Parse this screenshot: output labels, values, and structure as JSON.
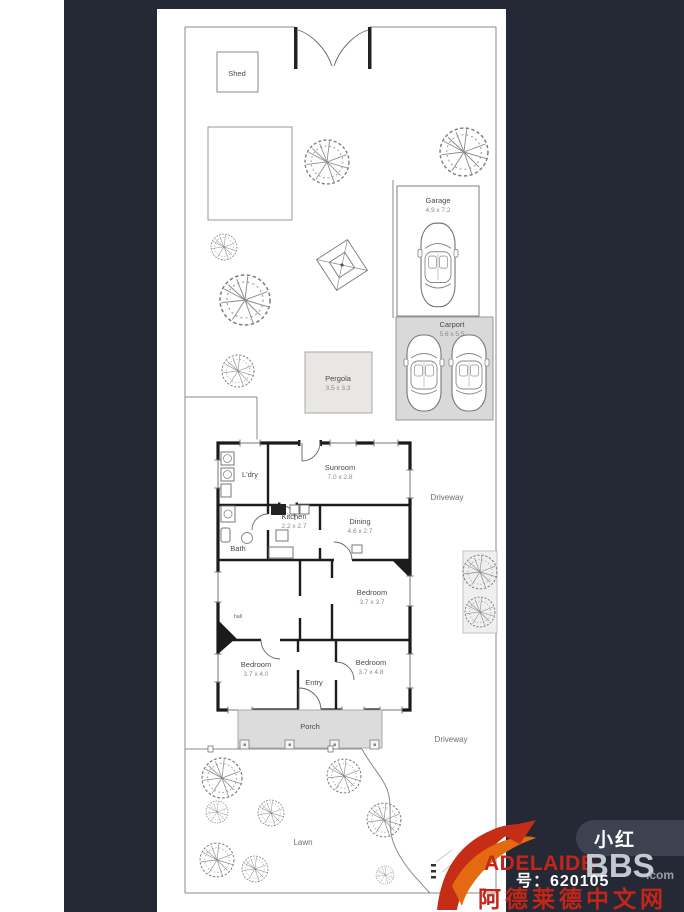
{
  "colors": {
    "page_bg": "#ffffff",
    "image_bg": "#242935",
    "sheet_bg": "#ffffff",
    "carport_fill": "#d9d9d9",
    "pergola_fill": "#e8e7e4",
    "porch_fill": "#dcdcdc",
    "paving_fill": "#efefef",
    "badge_bg": "#3c4250",
    "brand_red": "#c32619",
    "brand_gray": "#c3c9d2",
    "brand_tld_gray": "#99a0aa",
    "acct_white": "#ffffff"
  },
  "plan": {
    "shed": {
      "label": "Shed"
    },
    "garage": {
      "label": "Garage",
      "dims": "4.9 x 7.2"
    },
    "carport": {
      "label": "Carport",
      "dims": "5.6 x 5.5"
    },
    "pergola": {
      "label": "Pergola",
      "dims": "3.5 x 3.3"
    },
    "laundry": {
      "label": "L'dry"
    },
    "sunroom": {
      "label": "Sunroom",
      "dims": "7.0 x 2.8"
    },
    "kitchen": {
      "label": "Kitchen",
      "dims": "2.2 x 2.7"
    },
    "dining": {
      "label": "Dining",
      "dims": "4.6 x 2.7"
    },
    "bath": {
      "label": "Bath"
    },
    "hall": {
      "label": "hall"
    },
    "bedroom_mid": {
      "label": "Bedroom",
      "dims": "3.7 x 3.7"
    },
    "bedroom_front_left": {
      "label": "Bedroom",
      "dims": "3.7 x 4.0"
    },
    "entry": {
      "label": "Entry"
    },
    "bedroom_front_right": {
      "label": "Bedroom",
      "dims": "3.7 x 4.8"
    },
    "porch": {
      "label": "Porch"
    },
    "lawn": {
      "label": "Lawn"
    },
    "driveway_side": {
      "label": "Driveway"
    },
    "driveway_front": {
      "label": "Driveway"
    }
  },
  "watermark": {
    "badge": "小红",
    "brand_name": "ADELAIDE",
    "brand_suffix": "BBS",
    "brand_tld": ".com",
    "account_id": "号：620105",
    "chinese_name": "阿德莱德中文网"
  }
}
